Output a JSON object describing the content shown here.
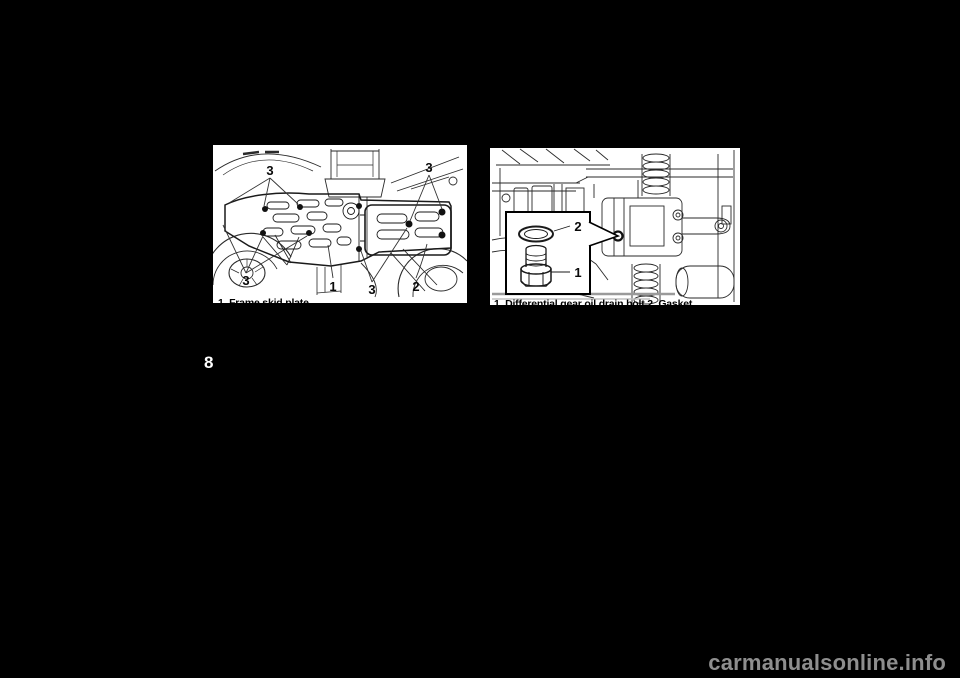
{
  "page": {
    "number": "8",
    "watermark": "carmanualsonline.info",
    "background_color": "#000000",
    "figure_background_color": "#ffffff",
    "watermark_color": "#8e8e8e"
  },
  "figure_skid_plates": {
    "description": "underside view of vehicle showing skid plates and mounting bolts",
    "caption": "1. Frame skid plate",
    "callouts": {
      "bolts_top_left": "3",
      "bolts_top_right": "3",
      "bolts_bottom_left": "3",
      "frame_skid_plate": "1",
      "bolts_bottom_center": "3",
      "rear_skid_plate": "2"
    }
  },
  "figure_drain_bolt": {
    "description": "underside engine view with inset of drain bolt and gasket",
    "caption": "1. Differential gear oil drain bolt  2. Gasket",
    "callouts": {
      "gasket": "2",
      "drain_bolt": "1"
    }
  }
}
